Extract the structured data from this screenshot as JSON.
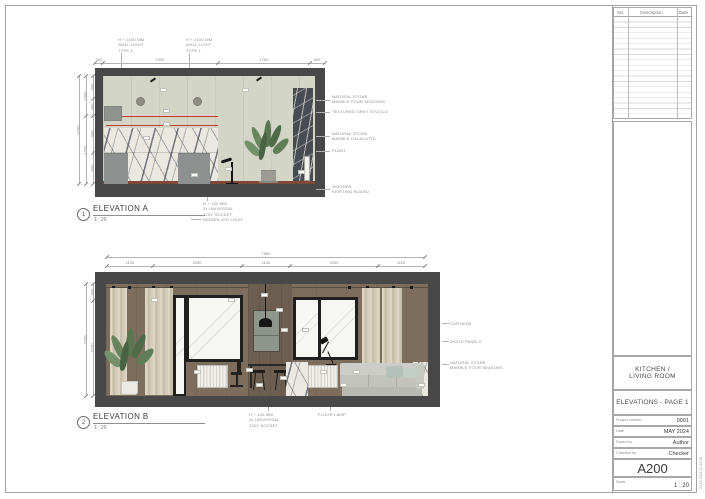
{
  "sheet": {
    "colors": {
      "level_line_red": "#c23b2e",
      "wall_section_grey": "#484848"
    }
  },
  "revision_table": {
    "headers": [
      "No.",
      "Description",
      "Date"
    ]
  },
  "title_block": {
    "project_title_1": "KITCHEN /",
    "project_title_2": "LIVING ROOM",
    "sheet_title": "ELEVATIONS - PAGE 1",
    "fields": [
      {
        "label": "Project number",
        "value": "0001"
      },
      {
        "label": "Date",
        "value": "MAY 2024"
      },
      {
        "label": "Drawn by",
        "value": "Author"
      },
      {
        "label": "Checked by",
        "value": "Checker"
      }
    ],
    "sheet_number": "A200",
    "scale_label": "Scale",
    "scale_value": "1 : 20",
    "plot_stamp": "23.05.2024 21:44:39"
  },
  "elevation_a": {
    "marker_number": "1",
    "title": "ELEVATION A",
    "scale": "1 : 20",
    "top_dims": [
      "300",
      "2330",
      "1780",
      "600"
    ],
    "left_dims_inner": [
      "600",
      "400",
      "900",
      "800"
    ],
    "left_dims_mid": [
      "1000",
      "1700"
    ],
    "left_dims_outer": [
      "2700"
    ],
    "callout_light_1": [
      "H + 2100 MM",
      "WALL LIGHT",
      "TYPE 1"
    ],
    "callout_light_2": [
      "H + 2100 MM",
      "WALL LIGHT",
      "TYPE 1"
    ],
    "callouts_right": [
      [
        "NATURAL STONE",
        "MARBLE FOUR SEASONS"
      ],
      [
        "TEXTURED GREY STUCCO"
      ],
      [
        "NATURAL STONE",
        "MARBLE CALACATTA"
      ],
      [
        "PLANT"
      ],
      [
        "WOODEN",
        "SKIRTING BOARD"
      ]
    ],
    "callout_socket": [
      "H + 100 MM",
      "2x UNIVERSAL",
      "220V SOCKET"
    ],
    "callout_led": "HIDDEN LED LIGHT"
  },
  "elevation_b": {
    "marker_number": "2",
    "title": "ELEVATION B",
    "scale": "1 : 20",
    "overall_dim": "7560",
    "top_dims": [
      "1120",
      "2090",
      "1140",
      "2090",
      "1110"
    ],
    "left_dims_inner": [
      "430",
      "2270"
    ],
    "left_dims_outer": [
      "2700"
    ],
    "callouts_right": [
      [
        "CURTAINS"
      ],
      [
        "WOOD PANELS"
      ],
      [
        "NATURAL STONE",
        "MARBLE FOUR SEASONS"
      ]
    ],
    "callout_socket": [
      "H + 100 MM",
      "2x UNIVERSAL",
      "220V SOCKET"
    ],
    "callout_lamp": "FLOOR LAMP"
  }
}
